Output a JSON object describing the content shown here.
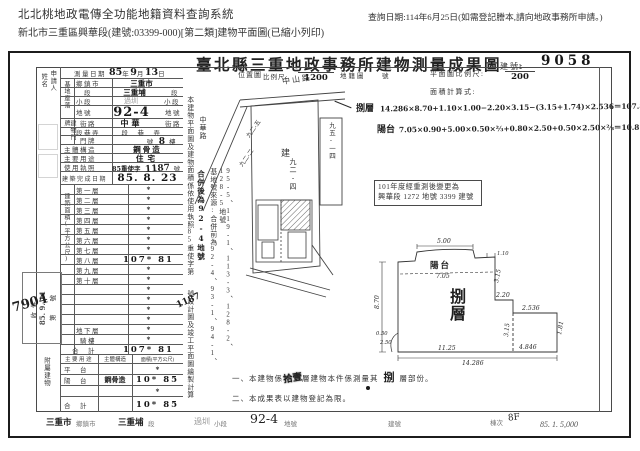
{
  "chrome": {
    "system_title": "北北桃地政電傳全功能地籍資料查詢系統",
    "query_date": "查詢日期:114年6月25日(如需登記謄本,請向地政事務所申請。)",
    "print_info": "新北市三重區興華段(建號:03399-000)[第二類]建物平面圖(已縮小列印)"
  },
  "doc": {
    "title": "臺北縣三重地政事務所建物測量成果圖",
    "building_no_label": "建號:",
    "building_no": "9058",
    "print_code": "85. 1. 5,000"
  },
  "applicant": {
    "label_right": "申請人",
    "label_left": "姓名"
  },
  "survey": {
    "label": "測量日期",
    "year": "85",
    "year_unit": "年",
    "month": "9",
    "month_unit": "月",
    "day": "13",
    "day_unit": "日"
  },
  "site": {
    "group": "基地座落",
    "rows": [
      {
        "label": "鄉鎮市",
        "value": "三重市",
        "suffix": ""
      },
      {
        "label": "段",
        "value": "三重埔",
        "suffix": "段"
      },
      {
        "label": "小段",
        "value": "過圳",
        "suffix": "小段"
      },
      {
        "label": "地號",
        "value": "92-4",
        "suffix": "地號"
      }
    ]
  },
  "door": {
    "group": "建物門牌",
    "street_label": "街路",
    "street_value": "中華",
    "street_suffix": "街路",
    "lane_label": "段巷弄",
    "lane_suffix": "段　巷　弄",
    "plate_label": "門牌",
    "plate_pre": "號",
    "plate_value": "8",
    "plate_suffix": "樓"
  },
  "build": {
    "structure_label": "主體構造",
    "structure_value": "鋼骨造",
    "use_label": "主要用途",
    "use_value": "住宅",
    "license_label": "使用執照",
    "license_pre": "85重使字",
    "license_no": "1187",
    "license_suffix": "號",
    "complete_label": "建築完成日期",
    "complete_value": "85. 8. 23"
  },
  "floor_area": {
    "group": "建築面積(平方公尺)",
    "rows": [
      {
        "label": "第一層",
        "value": "*"
      },
      {
        "label": "第二層",
        "value": "*"
      },
      {
        "label": "第三層",
        "value": "*"
      },
      {
        "label": "第四層",
        "value": "*"
      },
      {
        "label": "第五層",
        "value": "*"
      },
      {
        "label": "第六層",
        "value": "*"
      },
      {
        "label": "第七層",
        "value": "*"
      },
      {
        "label": "第八層",
        "value": "107* 81"
      },
      {
        "label": "第九層",
        "value": "*"
      },
      {
        "label": "第十層",
        "value": "*"
      },
      {
        "label": "",
        "value": "*"
      },
      {
        "label": "",
        "value": "*"
      },
      {
        "label": "",
        "value": "*"
      },
      {
        "label": "",
        "value": "*"
      },
      {
        "label": "地下層",
        "value": "*"
      },
      {
        "label": "騎樓",
        "value": "*"
      }
    ],
    "total_label": "合　計",
    "total_value": "107* 81"
  },
  "annex": {
    "group": "附屬建物",
    "headers": [
      "主要用途",
      "主體構造",
      "面積(平方公尺)"
    ],
    "rows": [
      {
        "use": "平　台",
        "structure": "",
        "area": "*"
      },
      {
        "use": "陽　台",
        "structure": "鋼骨造",
        "area": "10* 85"
      },
      {
        "use": "",
        "structure": "",
        "area": "*"
      }
    ],
    "total_label": "合　計",
    "total_value": "10* 85"
  },
  "stamp": {
    "line1": "收件",
    "line2": "85. 9. 11",
    "line3": "第　　號",
    "hand_no": "7904"
  },
  "side_notes": {
    "main_pre": "本建物平面圖及建物面積係依使用執照85重使字第",
    "main_no": "1187",
    "main_post": "號設計圖及竣工平面圖繪製計算",
    "origin_col1": "基地號來源:合併前為92-4、93-1、94-1、",
    "origin_col2": "95-5、119-1、113-3、128-2、128-5地號",
    "origin_hand": "合併後為92-4地號"
  },
  "scales": {
    "loc_label": "位置圖",
    "ratio_label": "比例尺:",
    "loc_num": "1",
    "loc_den": "1200",
    "cad_label": "地籍圖",
    "cad_suffix": "號",
    "plan_label": "平面圖比例尺:",
    "plan_num": "1",
    "plan_den": "200",
    "calc_label": "面積計算式:"
  },
  "formulas": {
    "floor_label": "捌層",
    "floor_expr": "14.286×8.70+1.10×1.00−2.20×3.15−(3.15+1.74)×2.536＝107.81",
    "balcony_label": "陽台",
    "balcony_expr": "7.05×0.90+5.00×0.50×⅔+0.80×2.50+0.50×2.50×⅔＝10.85"
  },
  "resurvey": {
    "line1": "101年度經重測後變更為",
    "line2": "興華段 1272 地號 3399 建號"
  },
  "map": {
    "road_top": "中山路",
    "road_left": "中華路",
    "center_mark": "建",
    "parcel_center": "九二-四",
    "parcel_a": "九二-五",
    "parcel_b": "九二-二",
    "parcel_right": "九五-一四",
    "parcel_br": "九五-一五"
  },
  "plan": {
    "floor_label": "捌層",
    "balcony_label": "陽台",
    "dims": {
      "balcony_w": "5.00",
      "balcony_total": "7.05",
      "left_h": "8.70",
      "right_a": "3.15",
      "step_w": "2.20",
      "notch": "1.10",
      "annex_top": "2.536",
      "annex_right": "1.81",
      "annex_h": "3.15",
      "annex_bottom": "4.846",
      "bottom_left": "11.25",
      "bottom_total": "14.286",
      "corner_a": "0.50",
      "corner_b": "2.50"
    }
  },
  "notes": {
    "n1_pre": "一、本建物係",
    "n1_hand1": "拾壹",
    "n1_mid": "層建物本件係測量其",
    "n1_hand2": "捌",
    "n1_suf": "層部份。",
    "n2": "二、本成果表以建物登記為限。"
  },
  "footer": {
    "town_value": "三重市",
    "town_label": "鄉鎮市",
    "sec_value": "三重埔",
    "sec_label": "段",
    "subsec_value": "過圳",
    "subsec_label": "小段",
    "lot_value": "92-4",
    "lot_label": "地號",
    "bno_label": "建號",
    "dong_label": "棟次",
    "dong_value": "8F"
  }
}
